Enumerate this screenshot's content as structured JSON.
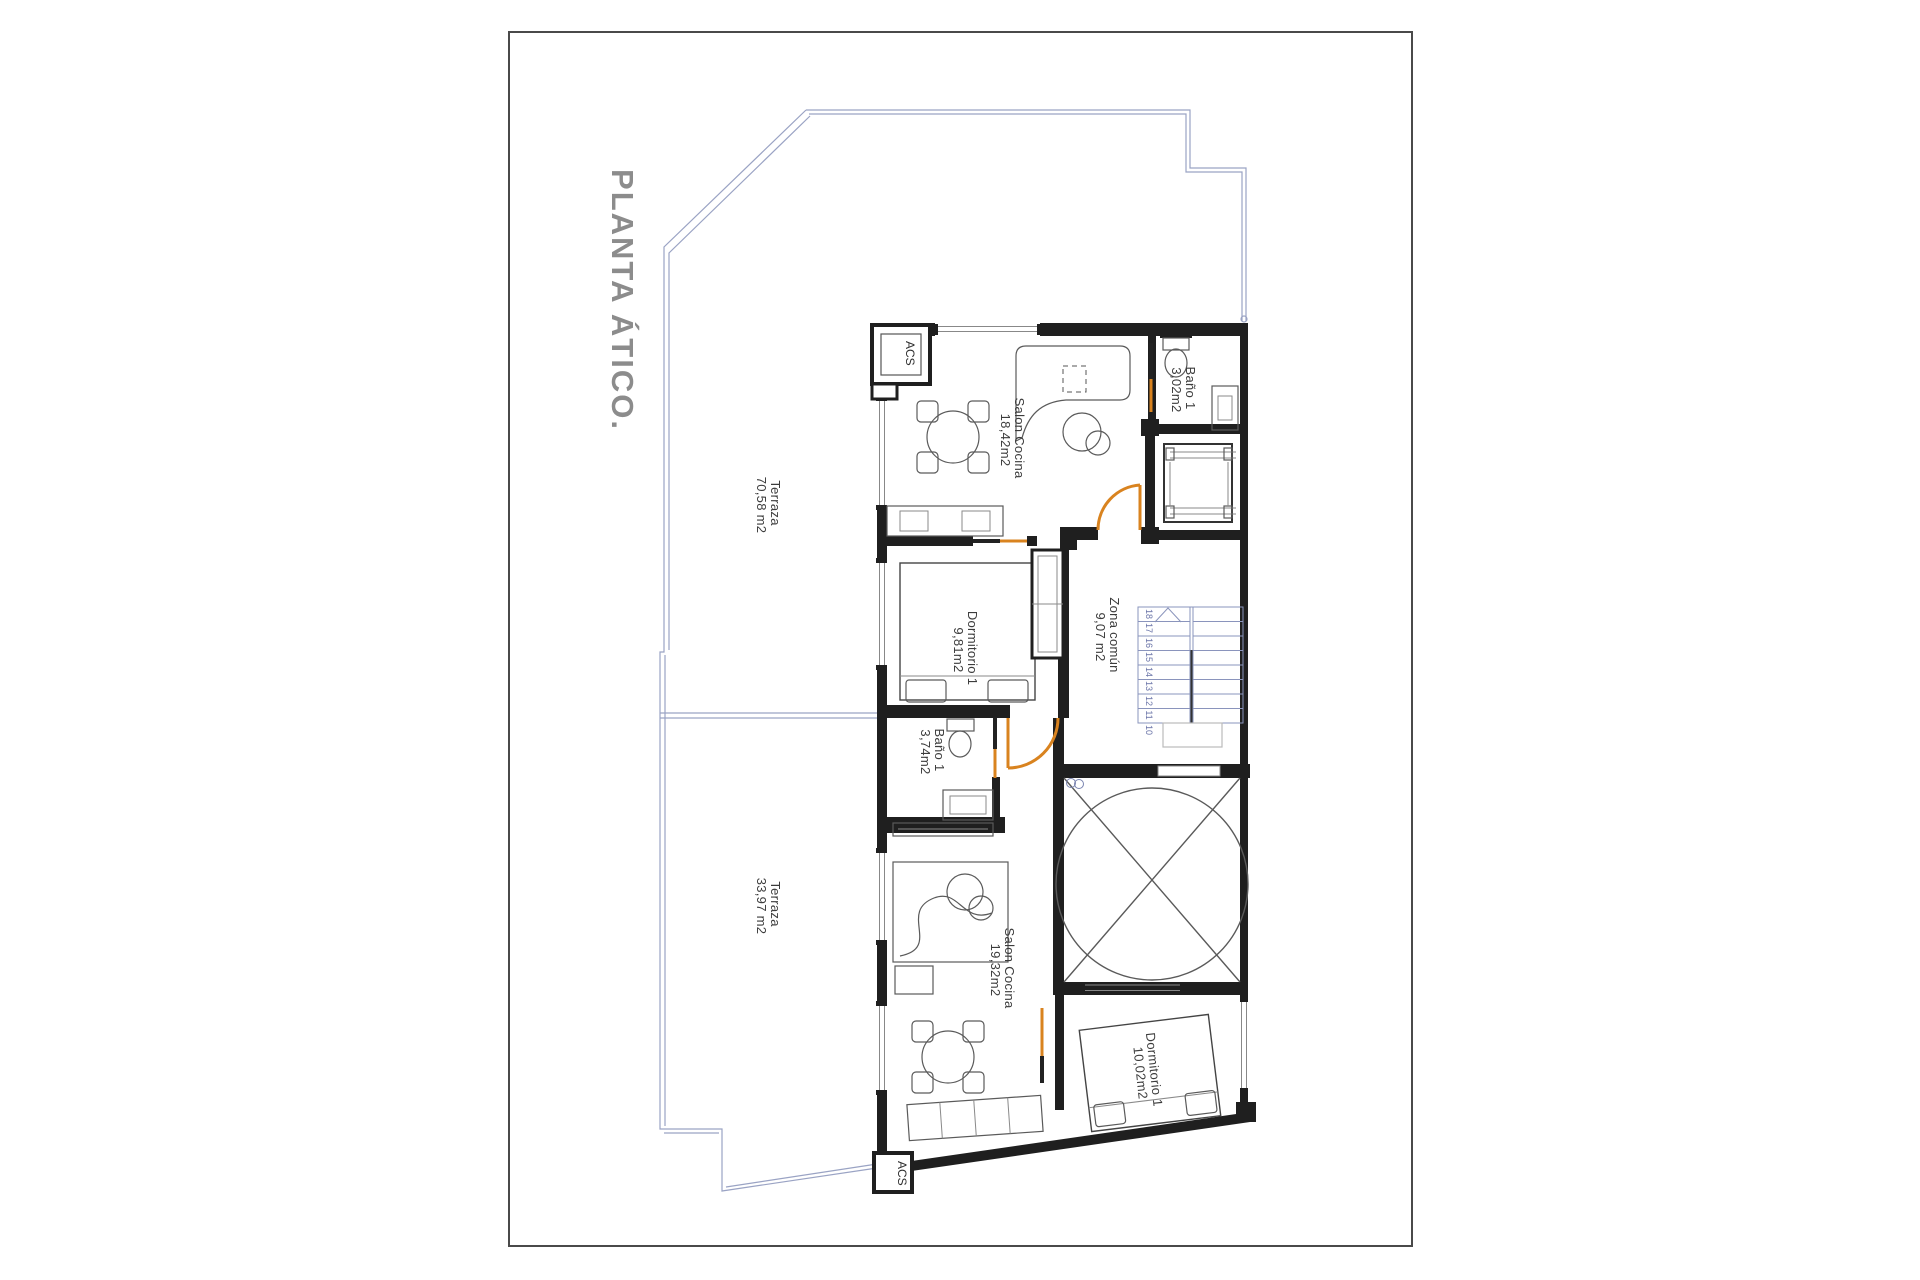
{
  "title": "PLANTA ÁTICO.",
  "rooms": {
    "terraza_a": {
      "name": "Terraza",
      "area": "70,58 m2"
    },
    "terraza_b": {
      "name": "Terraza",
      "area": "33,97 m2"
    },
    "salon_a": {
      "name": "Salon Cocina",
      "area": "18,42m2"
    },
    "bano_small_a": {
      "name": "Baño 1",
      "area": "3,02m2"
    },
    "dormitorio_a": {
      "name": "Dormitorio 1",
      "area": "9,81m2"
    },
    "zona_comun": {
      "name": "Zona común",
      "area": "9,07 m2"
    },
    "bano_a": {
      "name": "Baño 1",
      "area": "3,74m2"
    },
    "salon_b": {
      "name": "Salon Cocina",
      "area": "19,32m2"
    },
    "dormitorio_b": {
      "name": "Dormitorio 1",
      "area": "10,02m2"
    }
  },
  "acs": {
    "top": "ACS",
    "bottom": "ACS"
  },
  "stairs": {
    "steps": [
      "18",
      "17",
      "16",
      "15",
      "14",
      "13",
      "12",
      "11",
      "10"
    ]
  },
  "colors": {
    "door": "#d9831f",
    "wall": "#1f1f1f",
    "terrace_outline": "#9aa3c4",
    "stair_line": "#8a94bc",
    "title_gray": "#8c8c8c",
    "label_text": "#3c3c3c"
  }
}
